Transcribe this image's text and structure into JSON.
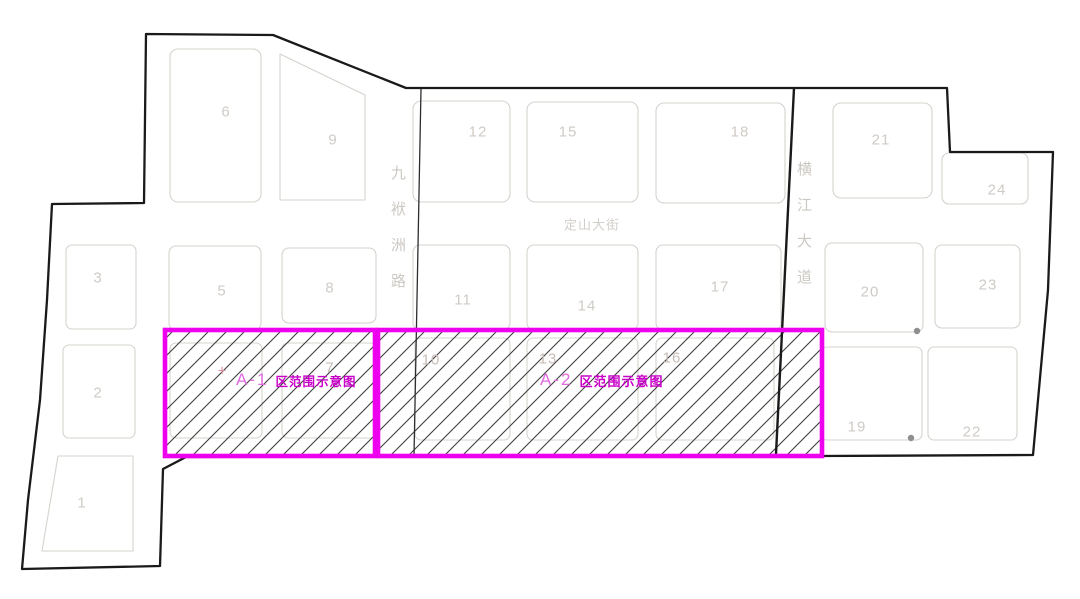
{
  "title": "地块区位示意图",
  "zones": {
    "a1": {
      "code": "A-1",
      "suffix": "区范围示意图"
    },
    "a2": {
      "code": "A-2",
      "suffix": "区范围示意图"
    }
  },
  "streets": {
    "jiufuzhou": "九袱洲路",
    "dingshan": "定山大街",
    "hengjiang": "横江大道"
  },
  "markers": {
    "plus": "+"
  },
  "parcel_labels": {
    "p1": "1",
    "p2": "2",
    "p3": "3",
    "p5": "5",
    "p6": "6",
    "p7": "7",
    "p8": "8",
    "p9": "9",
    "p10": "10",
    "p11": "11",
    "p12": "12",
    "p13": "13",
    "p14": "14",
    "p15": "15",
    "p16": "16",
    "p17": "17",
    "p18": "18",
    "p19": "19",
    "p20": "20",
    "p21": "21",
    "p22": "22",
    "p23": "23",
    "p24": "24"
  },
  "colors": {
    "zone_border": "#ee00ee",
    "zone_code_text": "#e06ce0",
    "zone_suffix_text": "#c800c8",
    "plus_marker": "#d98f9f",
    "outer_boundary": "#1a1a1a",
    "road_edge_line": "#1a1a1a",
    "parcel_outline": "#d6d3ce",
    "parcel_number": "#cfcbc6",
    "street_text": "#ccc8c3",
    "hatch_line": "#3f3f3f",
    "corner_dot": "#8f8f8f",
    "background": "#ffffff"
  }
}
